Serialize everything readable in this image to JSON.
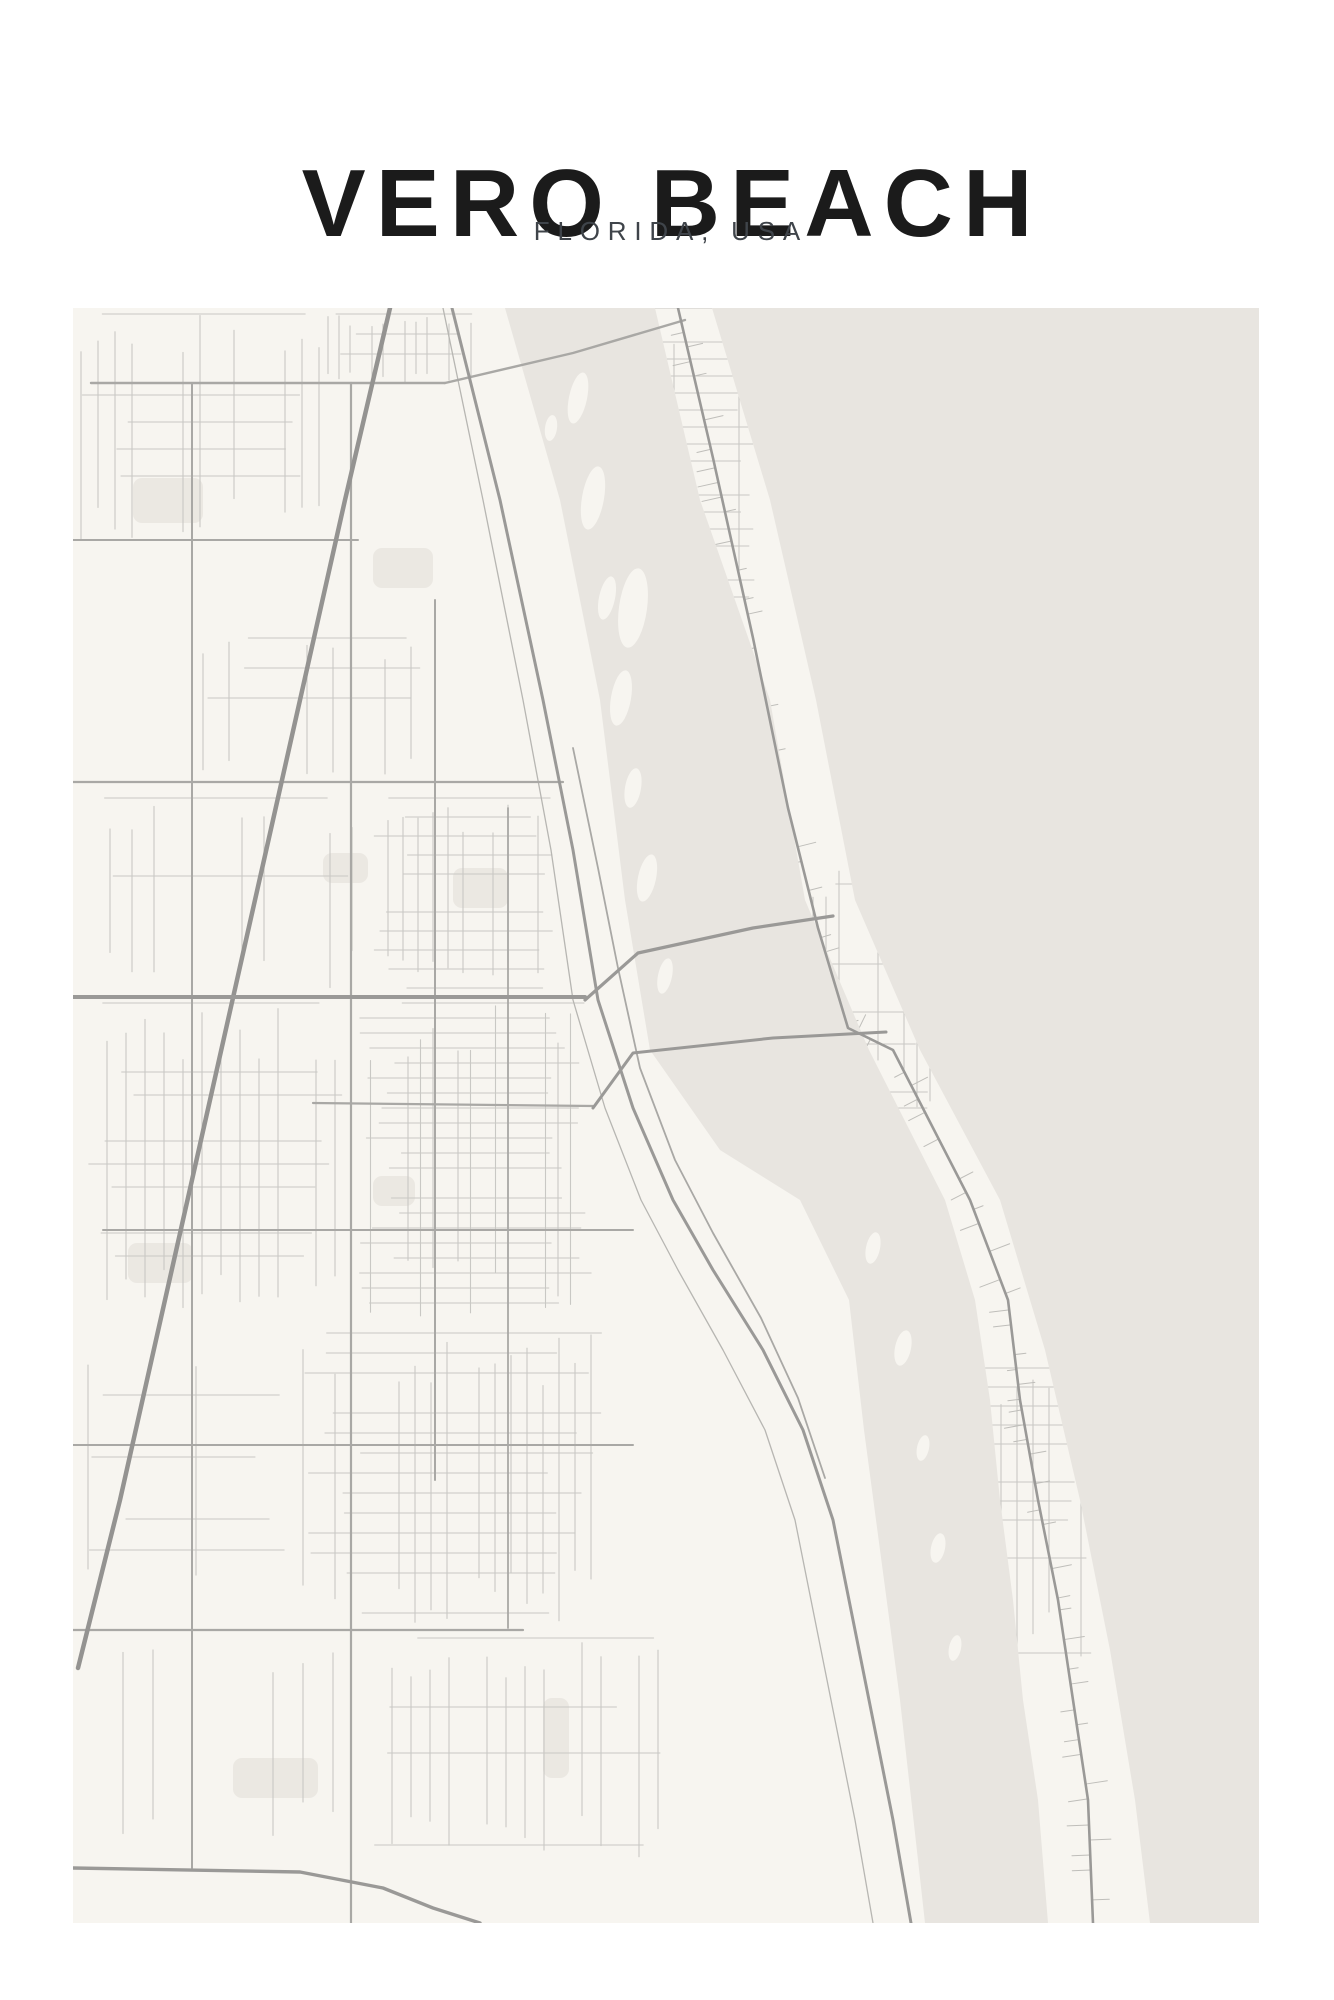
{
  "poster": {
    "title": "VERO BEACH",
    "subtitle": "FLORIDA, USA"
  },
  "colors": {
    "page_bg": "#ffffff",
    "title_text": "#1b1b1b",
    "subtitle_text": "#3f444a",
    "land": "#f7f5f0",
    "water": "#e8e5e0",
    "patch": "#ebe8e2",
    "road_minor": "#c9c8c4",
    "road_stub": "#bfbeba",
    "road_medium": "#a9a8a5",
    "road_major": "#9a9997",
    "highway": "#949391",
    "railway": "#b7b6b2"
  },
  "map": {
    "seed": 987654321,
    "width": 1186,
    "height": 1615,
    "water": [
      {
        "name": "atlantic-ocean",
        "path": "M639,0 L1186,0 L1186,1615 L1077,1615 L1062,1492 L1037,1342 L1007,1192 L972,1042 L927,892 L847,742 L782,592 L743,392 L697,192 Z"
      },
      {
        "name": "indian-river-lagoon",
        "path": "M432,0 L487,192 L527,392 L552,592 L577,742 L647,842 L727,892 L776,992 L791,1122 L807,1242 L827,1392 L845,1552 L852,1615 L975,1615 L965,1492 L950,1392 L940,1292 L927,1192 L917,1092 L902,992 L872,892 L796,742 L732,592 L697,392 L627,192 L582,0 Z"
      }
    ],
    "island_clip": "M582,0 L627,192 L697,392 L732,592 L796,742 L872,892 L902,992 L917,1092 L927,1192 L940,1292 L950,1392 L965,1492 L975,1615 L1077,1615 L1062,1492 L1037,1342 L1007,1192 L972,1042 L927,892 L847,742 L782,592 L743,392 L697,192 L639,0 Z",
    "lagoon_islands": [
      [
        505,
        90,
        9,
        26,
        12
      ],
      [
        478,
        120,
        6,
        13,
        8
      ],
      [
        520,
        190,
        11,
        32,
        10
      ],
      [
        534,
        290,
        8,
        22,
        12
      ],
      [
        560,
        300,
        14,
        40,
        8
      ],
      [
        548,
        390,
        10,
        28,
        10
      ],
      [
        560,
        480,
        8,
        20,
        10
      ],
      [
        574,
        570,
        9,
        24,
        12
      ],
      [
        592,
        668,
        7,
        18,
        12
      ],
      [
        800,
        940,
        7,
        16,
        12
      ],
      [
        830,
        1040,
        8,
        18,
        12
      ],
      [
        850,
        1140,
        6,
        13,
        12
      ],
      [
        865,
        1240,
        7,
        15,
        12
      ],
      [
        882,
        1340,
        6,
        13,
        12
      ]
    ],
    "patches": [
      [
        60,
        170,
        70,
        45
      ],
      [
        300,
        240,
        60,
        40
      ],
      [
        380,
        560,
        55,
        40
      ],
      [
        55,
        935,
        65,
        40
      ],
      [
        300,
        868,
        42,
        30
      ],
      [
        470,
        1390,
        26,
        80
      ],
      [
        160,
        1450,
        85,
        40
      ],
      [
        250,
        545,
        45,
        30
      ]
    ],
    "grids": [
      {
        "x": 8,
        "y": 6,
        "w": 240,
        "h": 230,
        "sx": 17,
        "sy": 27,
        "skip": 0.38
      },
      {
        "x": 255,
        "y": 6,
        "w": 145,
        "h": 70,
        "sx": 11,
        "sy": 20,
        "skip": 0.3
      },
      {
        "x": 130,
        "y": 330,
        "w": 250,
        "h": 140,
        "sx": 26,
        "sy": 30,
        "skip": 0.5
      },
      {
        "x": 300,
        "y": 490,
        "w": 190,
        "h": 190,
        "sx": 15,
        "sy": 19,
        "skip": 0.3
      },
      {
        "x": 15,
        "y": 490,
        "w": 270,
        "h": 190,
        "sx": 22,
        "sy": 26,
        "skip": 0.5
      },
      {
        "x": 285,
        "y": 695,
        "w": 235,
        "h": 320,
        "sx": 12.5,
        "sy": 15,
        "skip": 0.22
      },
      {
        "x": 15,
        "y": 695,
        "w": 260,
        "h": 320,
        "sx": 19,
        "sy": 23,
        "skip": 0.42
      },
      {
        "x": 230,
        "y": 1025,
        "w": 300,
        "h": 290,
        "sx": 16,
        "sy": 20,
        "skip": 0.35
      },
      {
        "x": 15,
        "y": 1025,
        "w": 200,
        "h": 290,
        "sx": 27,
        "sy": 31,
        "skip": 0.55
      },
      {
        "x": 300,
        "y": 1330,
        "w": 300,
        "h": 220,
        "sx": 19,
        "sy": 23,
        "skip": 0.5
      },
      {
        "x": 20,
        "y": 1330,
        "w": 260,
        "h": 200,
        "sx": 30,
        "sy": 34,
        "skip": 0.65
      }
    ],
    "island_grids": [
      {
        "x": 575,
        "y": 0,
        "w": 110,
        "h": 300,
        "sx": 13,
        "sy": 17,
        "skip": 0.45
      },
      {
        "x": 740,
        "y": 560,
        "w": 120,
        "h": 240,
        "sx": 13,
        "sy": 16,
        "skip": 0.4
      },
      {
        "x": 880,
        "y": 1060,
        "w": 140,
        "h": 300,
        "sx": 16,
        "sy": 19,
        "skip": 0.6
      }
    ],
    "stubs": {
      "road": "a1a-highway",
      "step": 15,
      "skip": 0.35,
      "min": 8,
      "max": 22
    },
    "roads": [
      {
        "name": "fec-railway",
        "color": "railway",
        "w": 1.3,
        "pts": [
          [
            370,
            0
          ],
          [
            410,
            192
          ],
          [
            450,
            392
          ],
          [
            478,
            542
          ],
          [
            500,
            692
          ],
          [
            532,
            800
          ],
          [
            568,
            892
          ],
          [
            605,
            962
          ],
          [
            650,
            1042
          ],
          [
            692,
            1122
          ],
          [
            722,
            1212
          ],
          [
            742,
            1312
          ],
          [
            762,
            1412
          ],
          [
            782,
            1512
          ],
          [
            800,
            1615
          ]
        ]
      },
      {
        "name": "indian-river-boulevard",
        "color": "road_medium",
        "w": 1.8,
        "pts": [
          [
            500,
            440
          ],
          [
            525,
            560
          ],
          [
            545,
            660
          ],
          [
            567,
            760
          ],
          [
            602,
            852
          ],
          [
            640,
            925
          ],
          [
            688,
            1010
          ],
          [
            725,
            1090
          ],
          [
            752,
            1170
          ]
        ]
      },
      {
        "name": "cr510-road",
        "color": "road_medium",
        "w": 2.4,
        "pts": [
          [
            18,
            75
          ],
          [
            372,
            75
          ]
        ]
      },
      {
        "name": "cr510-wabasso-bridge",
        "color": "road_medium",
        "w": 2.4,
        "pts": [
          [
            372,
            75
          ],
          [
            500,
            45
          ],
          [
            612,
            12
          ]
        ]
      },
      {
        "name": "26th-street-road",
        "color": "road_medium",
        "w": 2.0,
        "pts": [
          [
            0,
            232
          ],
          [
            285,
            232
          ]
        ]
      },
      {
        "name": "41st-street-road",
        "color": "road_medium",
        "w": 2.2,
        "pts": [
          [
            0,
            474
          ],
          [
            490,
            474
          ]
        ]
      },
      {
        "name": "12th-street-road",
        "color": "road_medium",
        "w": 2.0,
        "pts": [
          [
            30,
            922
          ],
          [
            560,
            922
          ]
        ]
      },
      {
        "name": "4th-street-road",
        "color": "road_medium",
        "w": 2.0,
        "pts": [
          [
            0,
            1137
          ],
          [
            560,
            1137
          ]
        ]
      },
      {
        "name": "oslo-road",
        "color": "road_medium",
        "w": 2.2,
        "pts": [
          [
            0,
            1322
          ],
          [
            450,
            1322
          ]
        ]
      },
      {
        "name": "66th-avenue-road",
        "color": "road_medium",
        "w": 2.0,
        "pts": [
          [
            119,
            75
          ],
          [
            119,
            1560
          ]
        ]
      },
      {
        "name": "58th-avenue-road",
        "color": "road_medium",
        "w": 2.2,
        "pts": [
          [
            278,
            75
          ],
          [
            278,
            1615
          ]
        ]
      },
      {
        "name": "43rd-avenue-road",
        "color": "road_medium",
        "w": 2.0,
        "pts": [
          [
            362,
            292
          ],
          [
            362,
            1172
          ]
        ]
      },
      {
        "name": "27th-avenue-road",
        "color": "road_medium",
        "w": 1.8,
        "pts": [
          [
            435,
            500
          ],
          [
            435,
            1320
          ]
        ]
      },
      {
        "name": "16th-street-road",
        "color": "road_medium",
        "w": 2.2,
        "pts": [
          [
            240,
            795
          ],
          [
            520,
            798
          ]
        ]
      },
      {
        "name": "south-county-curve-road",
        "color": "road_major",
        "w": 3.4,
        "pts": [
          [
            0,
            1560
          ],
          [
            227,
            1564
          ],
          [
            310,
            1580
          ],
          [
            360,
            1600
          ],
          [
            407,
            1615
          ]
        ]
      },
      {
        "name": "interstate-95",
        "color": "highway",
        "w": 4.5,
        "pts": [
          [
            317,
            0
          ],
          [
            272,
            192
          ],
          [
            227,
            392
          ],
          [
            182,
            592
          ],
          [
            137,
            792
          ],
          [
            92,
            992
          ],
          [
            47,
            1192
          ],
          [
            5,
            1360
          ]
        ]
      },
      {
        "name": "us1-highway",
        "color": "road_major",
        "w": 3.0,
        "pts": [
          [
            379,
            0
          ],
          [
            427,
            192
          ],
          [
            470,
            392
          ],
          [
            500,
            542
          ],
          [
            525,
            692
          ],
          [
            560,
            800
          ],
          [
            600,
            892
          ],
          [
            640,
            962
          ],
          [
            690,
            1042
          ],
          [
            730,
            1122
          ],
          [
            760,
            1212
          ],
          [
            780,
            1312
          ],
          [
            800,
            1412
          ],
          [
            820,
            1512
          ],
          [
            838,
            1615
          ]
        ]
      },
      {
        "name": "sr60-20th-street-road",
        "color": "road_major",
        "w": 4.0,
        "pts": [
          [
            0,
            689
          ],
          [
            512,
            689
          ]
        ]
      },
      {
        "name": "merrill-barber-bridge",
        "color": "road_major",
        "w": 3.2,
        "pts": [
          [
            512,
            692
          ],
          [
            565,
            645
          ],
          [
            680,
            620
          ],
          [
            760,
            608
          ]
        ]
      },
      {
        "name": "17th-street-bridge",
        "color": "road_major",
        "w": 3.0,
        "pts": [
          [
            520,
            800
          ],
          [
            560,
            745
          ],
          [
            700,
            730
          ],
          [
            813,
            724
          ]
        ]
      },
      {
        "name": "a1a-highway",
        "color": "road_major",
        "w": 2.6,
        "pts": [
          [
            605,
            0
          ],
          [
            640,
            150
          ],
          [
            680,
            330
          ],
          [
            715,
            500
          ],
          [
            745,
            620
          ],
          [
            775,
            720
          ],
          [
            820,
            742
          ],
          [
            897,
            892
          ],
          [
            935,
            992
          ],
          [
            947,
            1092
          ],
          [
            965,
            1192
          ],
          [
            985,
            1292
          ],
          [
            1000,
            1392
          ],
          [
            1015,
            1492
          ],
          [
            1020,
            1615
          ]
        ]
      }
    ]
  }
}
